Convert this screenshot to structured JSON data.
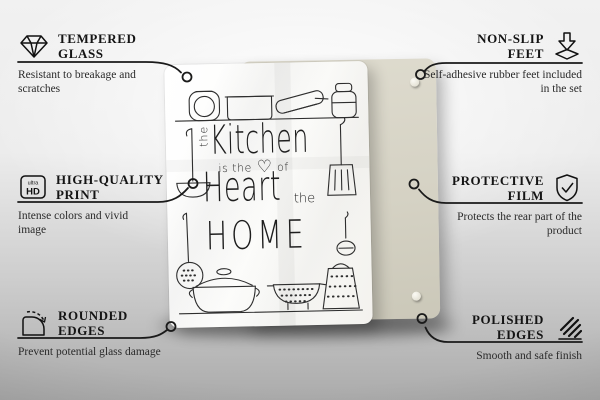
{
  "callouts": {
    "tempered_glass": {
      "icon": "diamond-icon",
      "title": "TEMPERED GLASS",
      "description": "Resistant to breakage and scratches"
    },
    "non_slip_feet": {
      "icon": "press-down-icon",
      "title": "NON-SLIP FEET",
      "description": "Self-adhesive rubber feet included in the set"
    },
    "high_quality_print": {
      "icon": "ultra-hd-icon",
      "title": "HIGH-QUALITY PRINT",
      "description": "Intense colors and vivid image",
      "icon_text_top": "ultra",
      "icon_text_bottom": "HD"
    },
    "protective_film": {
      "icon": "shield-check-icon",
      "title": "PROTECTIVE FILM",
      "description": "Protects the rear part of the product"
    },
    "rounded_edges": {
      "icon": "rounded-corner-icon",
      "title": "ROUNDED EDGES",
      "description": "Prevent potential glass damage"
    },
    "polished_edges": {
      "icon": "hatch-stripes-icon",
      "title": "POLISHED EDGES",
      "description": "Smooth and safe finish"
    }
  },
  "product": {
    "quote": {
      "the_vertical": "the",
      "kitchen": "Kitchen",
      "is_the": "is the",
      "heart_symbol": "♡",
      "of": "of",
      "heart": "Heart",
      "the_right": "the",
      "home": "HOME"
    }
  },
  "colors": {
    "connector_line": "#1a1a1a",
    "back_panel": "#d5d2c4",
    "glass": "#ffffff",
    "illustration_stroke": "#2e2e2e"
  }
}
